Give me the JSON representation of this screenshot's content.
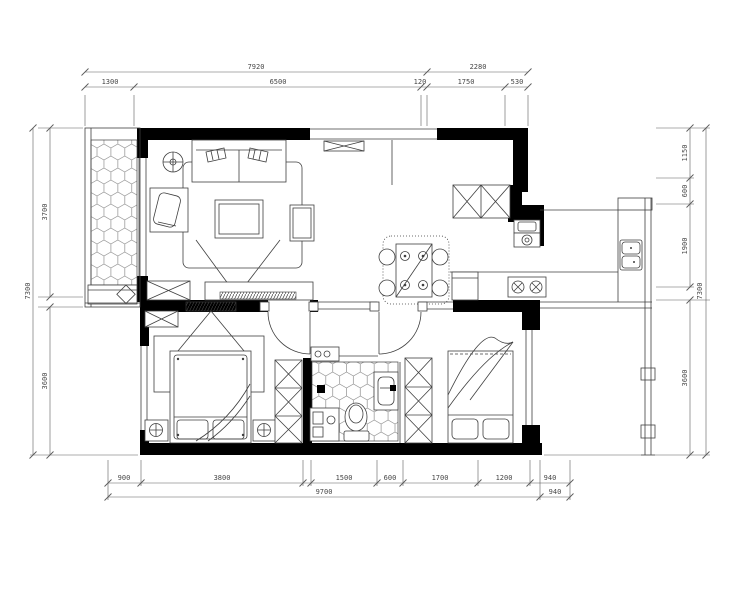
{
  "dims": {
    "top": {
      "overall_left": "7920",
      "overall_right": "2280",
      "segments": [
        "1300",
        "6500",
        "120",
        "1750",
        "530"
      ]
    },
    "bottom": {
      "segments": [
        "900",
        "3800",
        "1500",
        "600",
        "1700",
        "1200",
        "940"
      ],
      "overall": "9700",
      "side": "940"
    },
    "left": {
      "segments": [
        "3700",
        "3600"
      ],
      "overall": "7300"
    },
    "right": {
      "segments": [
        "1150",
        "600",
        "1900",
        "3600"
      ],
      "overall": "7300"
    }
  },
  "colors": {
    "wall": "#000000",
    "line": "#3f3f3f",
    "dim_text": "#474747",
    "tile": "#8f8f8f",
    "background": "#ffffff"
  }
}
